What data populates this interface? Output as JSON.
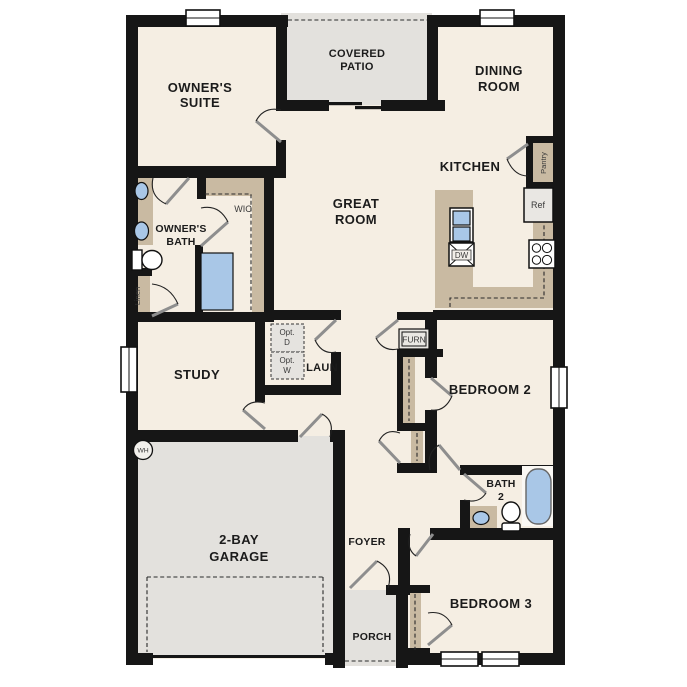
{
  "plan": {
    "rooms": {
      "owners_suite": {
        "line1": "OWNER'S",
        "line2": "SUITE"
      },
      "covered_patio": {
        "line1": "COVERED",
        "line2": "PATIO"
      },
      "dining_room": {
        "line1": "DINING",
        "line2": "ROOM"
      },
      "kitchen": {
        "label": "KITCHEN"
      },
      "great_room": {
        "line1": "GREAT",
        "line2": "ROOM"
      },
      "owners_bath": {
        "line1": "OWNER'S",
        "line2": "BATH"
      },
      "wic": {
        "label": "WIC"
      },
      "study": {
        "label": "STUDY"
      },
      "laundry": {
        "label": "LAUN"
      },
      "bedroom_2": {
        "label": "BEDROOM 2"
      },
      "bath_2": {
        "line1": "BATH",
        "line2": "2"
      },
      "bedroom_3": {
        "label": "BEDROOM 3"
      },
      "garage": {
        "line1": "2-BAY",
        "line2": "GARAGE"
      },
      "foyer": {
        "label": "FOYER"
      },
      "porch": {
        "label": "PORCH"
      }
    },
    "fixtures": {
      "pantry": "Pantry",
      "refrigerator": "Ref",
      "dishwasher": "DW",
      "furnace": "FURN",
      "linen": "Linen",
      "water_heater": "WH",
      "opt_dryer": {
        "line1": "Opt.",
        "line2": "D"
      },
      "opt_washer": {
        "line1": "Opt.",
        "line2": "W"
      }
    },
    "colors": {
      "wall": "#161616",
      "floor": "#f5eee3",
      "patio_garage_grey": "#e3e1dd",
      "casework_tan": "#c9baa2",
      "fixture_blue": "#a9c7e7",
      "appliance_grey": "#e9e7e3"
    }
  }
}
